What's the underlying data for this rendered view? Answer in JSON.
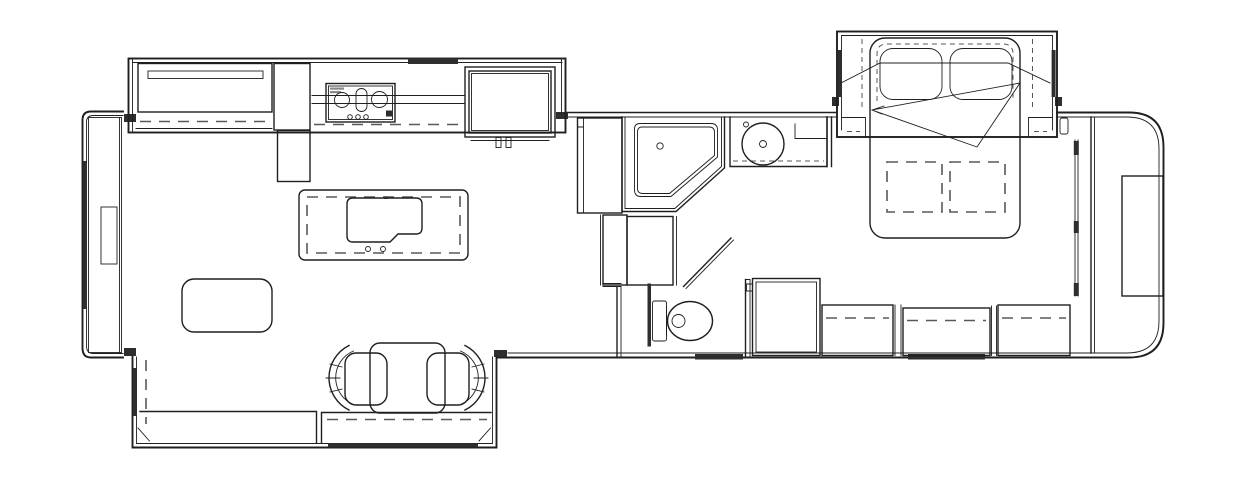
{
  "diagram": {
    "type": "floorplan",
    "subject": "RV fifth-wheel travel trailer floor plan, top-down black-and-white line drawing",
    "orientation": "front (hitch end) at left, rear cap at right",
    "rooms": [
      "living-kitchen area",
      "bathroom",
      "bedroom",
      "rear closet"
    ],
    "slideouts": [
      "kitchen-entertainment slide (top left)",
      "sofa slide (bottom left)",
      "bed slide (top right)"
    ]
  },
  "colors": {
    "background": "#ffffff",
    "line": "#1f1f1f",
    "dashed": "#585858",
    "window_fill": "#2e2e2e",
    "label_fill": "#8a8a8a"
  },
  "fixtures": {
    "front_cap": "Front cap wall with window and TV console",
    "front_tv": "Front TV / cabinet",
    "entertainment_center": "Entertainment center with TV",
    "cooktop": "3-burner cooktop with knobs",
    "range_vent": "Range vent (dark bar)",
    "refrigerator": "Refrigerator with double door handles",
    "pantry": "Pantry cabinet",
    "island": "Kitchen island with sink and faucet",
    "ottoman": "Ottoman / coffee table",
    "dinette_table": "Dinette table",
    "dinette_chair_left": "Dinette chair (left)",
    "dinette_chair_right": "Dinette chair (right)",
    "sofa": "Sofa / theater seating in slide-out",
    "sofa_console": "Sofa-side console cabinet",
    "living_slide": "Living room slide-out",
    "kitchen_slide": "Kitchen slide-out",
    "shower": "Neo-angle corner shower with drain",
    "linen_cabinet": "Linen cabinet beside shower",
    "steps": "Steps / washer-dryer cabinet",
    "vanity": "Bathroom vanity with round sink",
    "toilet": "Toilet with tank",
    "bath_door": "Bathroom swing door",
    "pocket_door": "Pocket door panel",
    "entry_door": "Entry door (dark bar on lower wall)",
    "bed_slide": "Bedroom bed slide-out",
    "bed": "Queen bed with two pillows",
    "bed_foot_storage": "Under-bed storage (dashed)",
    "blanket_fold": "Comforter fold lines",
    "wardrobe_cabinet": "Bedroom wardrobe cabinet",
    "dresser_left": "Dresser section (left)",
    "dresser_center": "Dresser section (center) with window",
    "dresser_right": "Dresser section (right)",
    "bedroom_window": "Bedroom window",
    "closet_track": "Sliding closet door track",
    "rear_wardrobe": "Rear closet wardrobe",
    "rear_cap": "Rounded rear cap wall"
  }
}
